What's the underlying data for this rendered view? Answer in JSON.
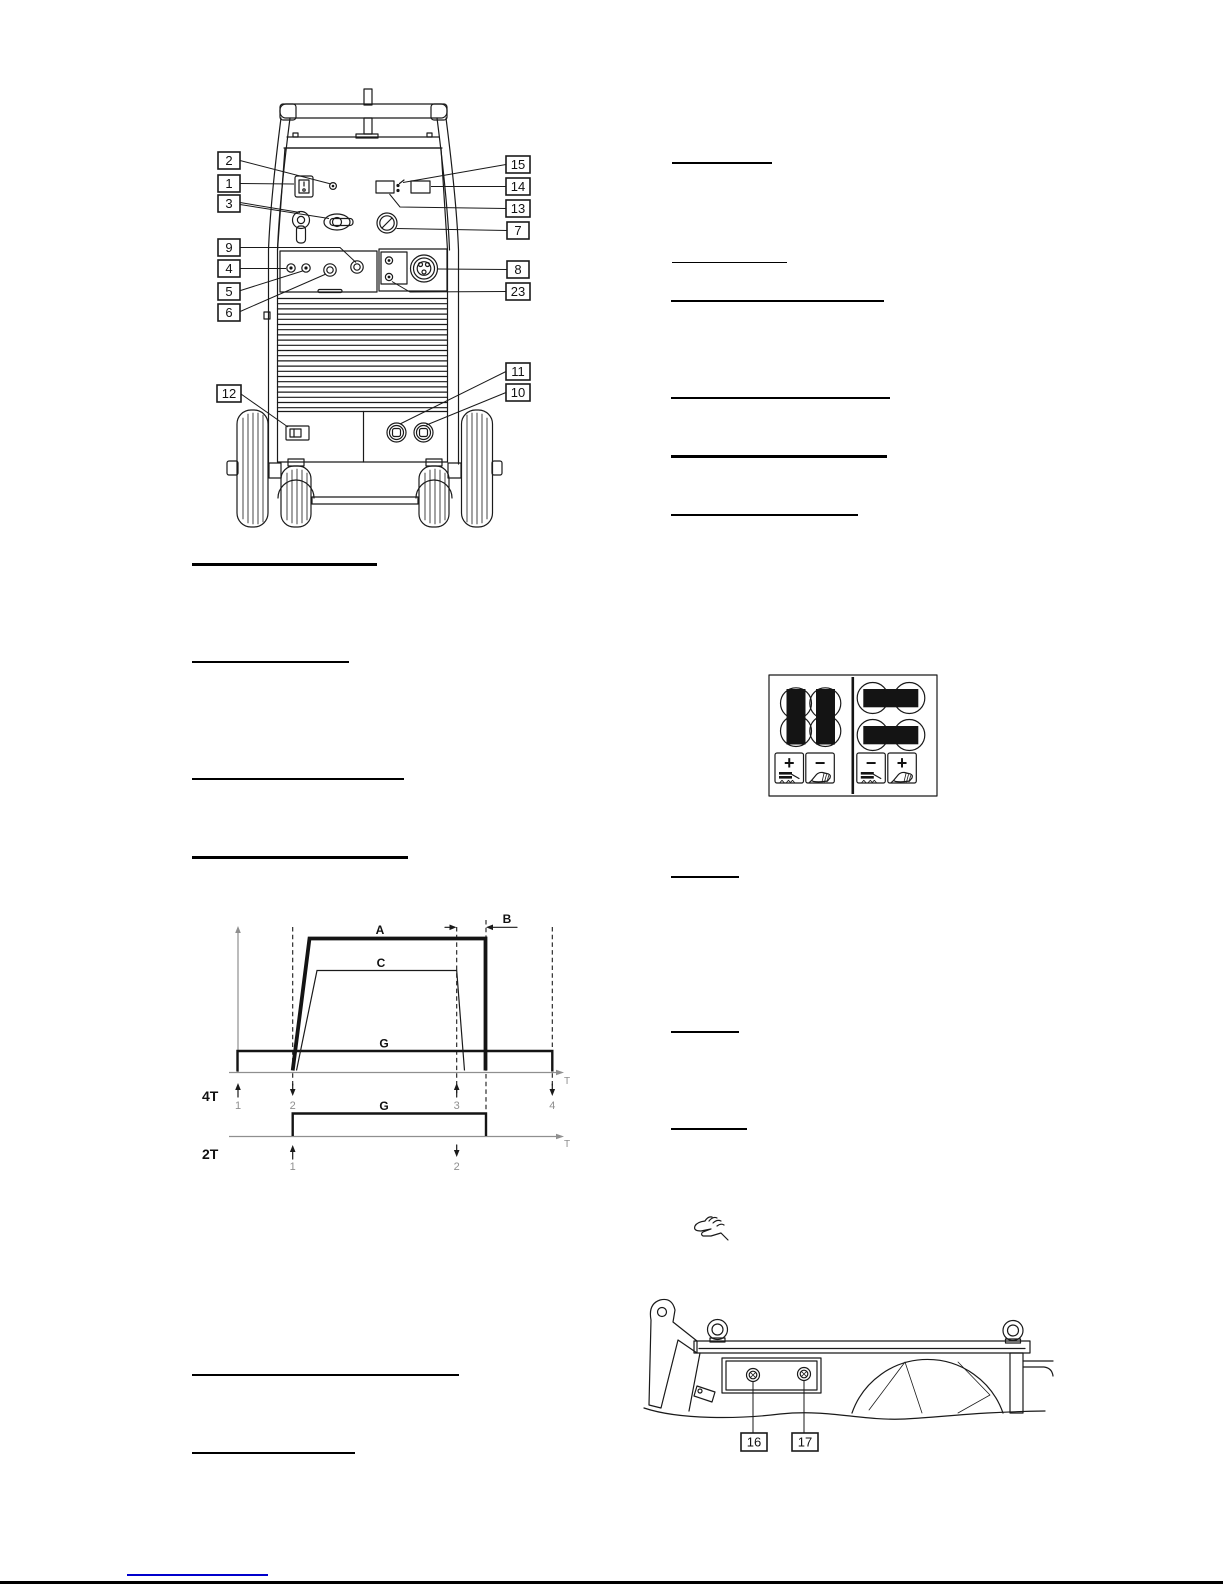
{
  "front_view": {
    "callouts": {
      "c1": "1",
      "c2": "2",
      "c3": "3",
      "c4": "4",
      "c5": "5",
      "c6": "6",
      "c7": "7",
      "c8": "8",
      "c9": "9",
      "c10": "10",
      "c11": "11",
      "c12": "12",
      "c13": "13",
      "c14": "14",
      "c15": "15",
      "c23": "23"
    }
  },
  "base_view": {
    "callouts": {
      "c16": "16",
      "c17": "17"
    }
  },
  "timing_diagram": {
    "curve_labels": {
      "a": "A",
      "b": "B",
      "c": "C",
      "g_upper": "G",
      "g_lower": "G"
    },
    "axis_labels": {
      "t_upper": "T",
      "t_lower": "T"
    },
    "mode_labels": {
      "four_stroke": "4T",
      "two_stroke": "2T"
    },
    "markers_4t": [
      "1",
      "2",
      "3",
      "4"
    ],
    "markers_2t": [
      "1",
      "2"
    ]
  },
  "polarity_diagram": {
    "signs": [
      "+",
      "−",
      "−",
      "+"
    ]
  },
  "colors": {
    "ink": "#1a1a1a",
    "axis_gray": "#8f8f8f",
    "link_blue": "#0000cc"
  }
}
